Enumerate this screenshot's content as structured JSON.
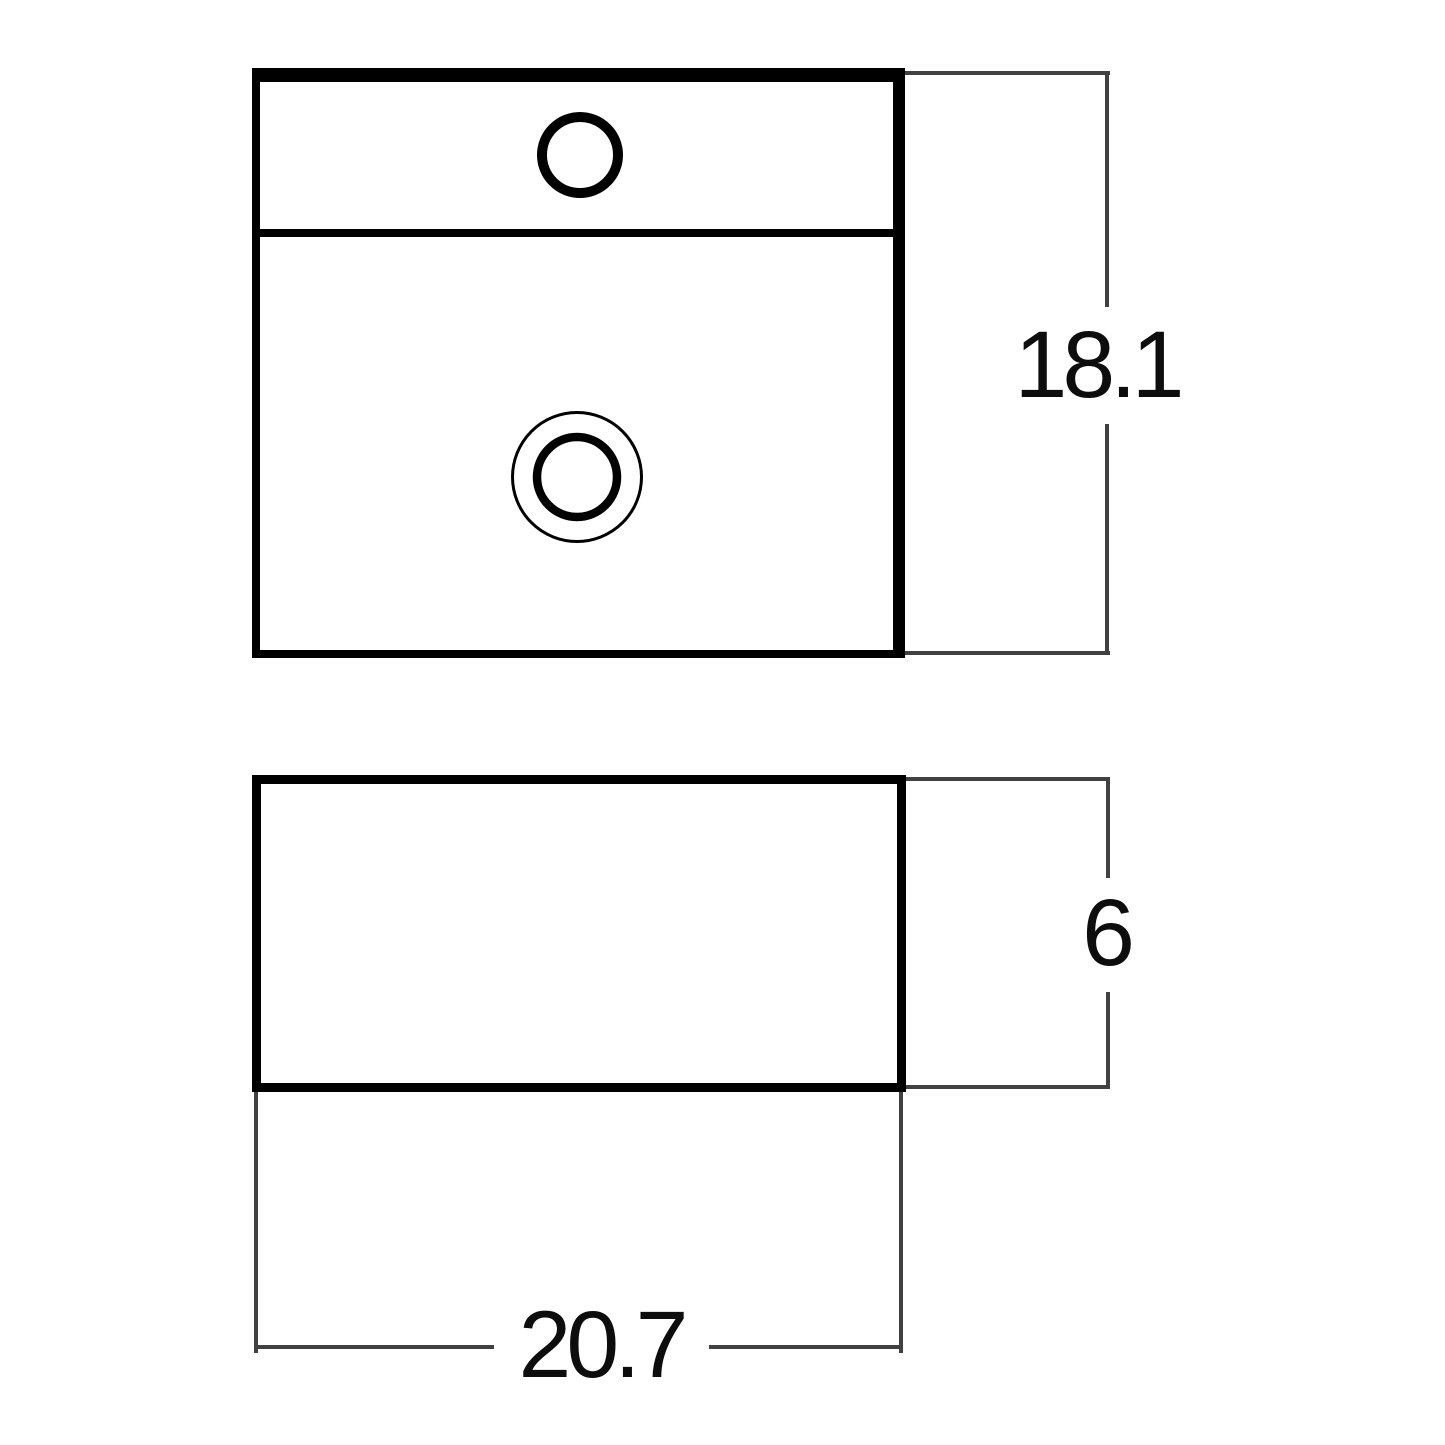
{
  "labels": {
    "depth": "18.1",
    "height": "6",
    "width": "20.7"
  },
  "colors": {
    "outline": "#000000",
    "dimension_line": "#414141",
    "label_text": "#0d0d0d",
    "background": "#ffffff"
  }
}
